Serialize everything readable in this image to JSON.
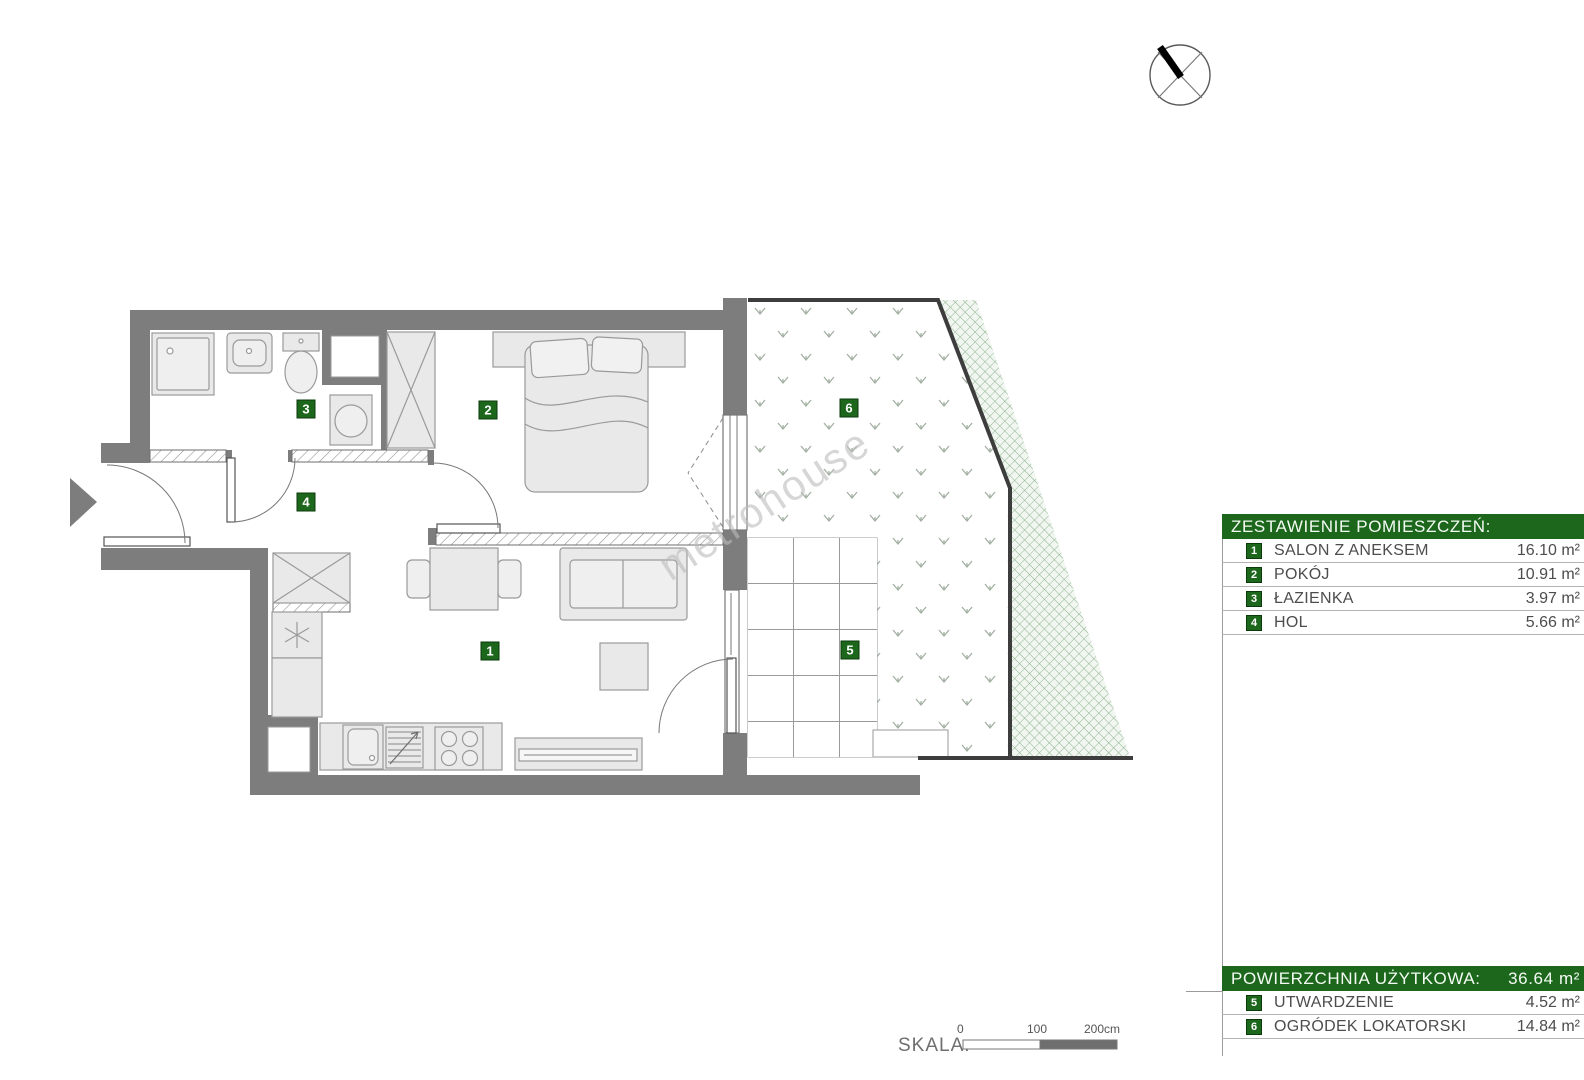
{
  "plan": {
    "watermark": "metrohouse",
    "badges": [
      "1",
      "2",
      "3",
      "4",
      "5",
      "6"
    ]
  },
  "legend": {
    "title": "ZESTAWIENIE POMIESZCZEŃ:",
    "rooms": [
      {
        "num": "1",
        "label": "SALON Z ANEKSEM",
        "area": "16.10 m²"
      },
      {
        "num": "2",
        "label": "POKÓJ",
        "area": "10.91 m²"
      },
      {
        "num": "3",
        "label": "ŁAZIENKA",
        "area": "3.97 m²"
      },
      {
        "num": "4",
        "label": "HOL",
        "area": "5.66 m²"
      }
    ]
  },
  "summary": {
    "title": "POWIERZCHNIA UŻYTKOWA:",
    "total": "36.64 m²",
    "rows": [
      {
        "num": "5",
        "label": "UTWARDZENIE",
        "area": "4.52 m²"
      },
      {
        "num": "6",
        "label": "OGRÓDEK LOKATORSKI",
        "area": "14.84 m²"
      }
    ]
  },
  "scale": {
    "label": "SKALA:",
    "t0": "0",
    "t100": "100",
    "t200": "200cm"
  },
  "colors": {
    "accent_green": "#1d671d",
    "wall_gray": "#7d7d7d",
    "boundary_dark": "#3d3d3d",
    "hatch_green": "#8ab08a",
    "furniture_fill": "#e9e9e9"
  }
}
